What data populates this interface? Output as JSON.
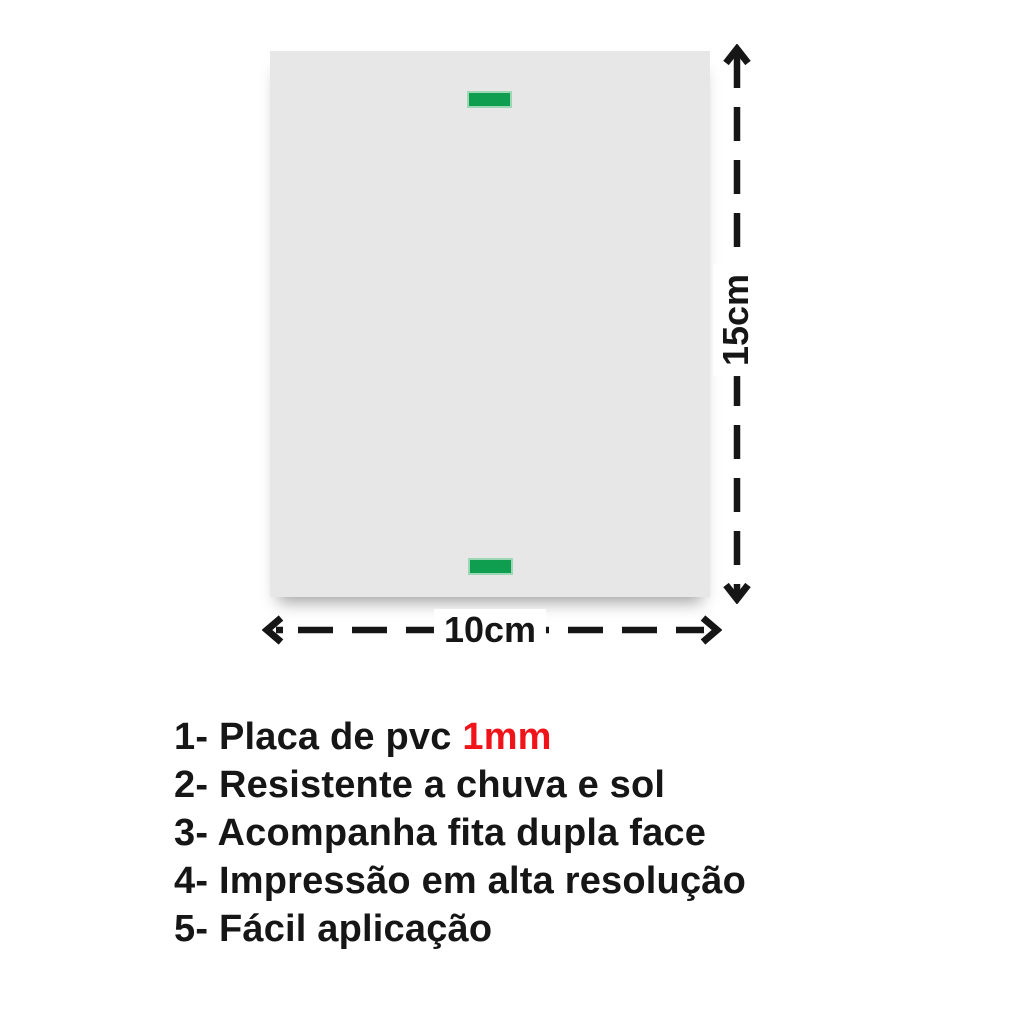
{
  "colors": {
    "background": "#ffffff",
    "ink": "#161616",
    "plate_gray": "#e7e7e7",
    "tape_green": "#0f9e50",
    "tape_green_edge": "#9ed7b6",
    "highlight_red": "#f0141a"
  },
  "dimensions": {
    "height_label": "15cm",
    "width_label": "10cm"
  },
  "features": {
    "items": [
      {
        "text": "1- Placa de pvc ",
        "highlight": "1mm"
      },
      {
        "text": "2- Resistente a chuva e sol"
      },
      {
        "text": "3- Acompanha fita dupla face"
      },
      {
        "text": "4- Impressão em alta resolução"
      },
      {
        "text": "5- Fácil aplicação"
      }
    ]
  }
}
